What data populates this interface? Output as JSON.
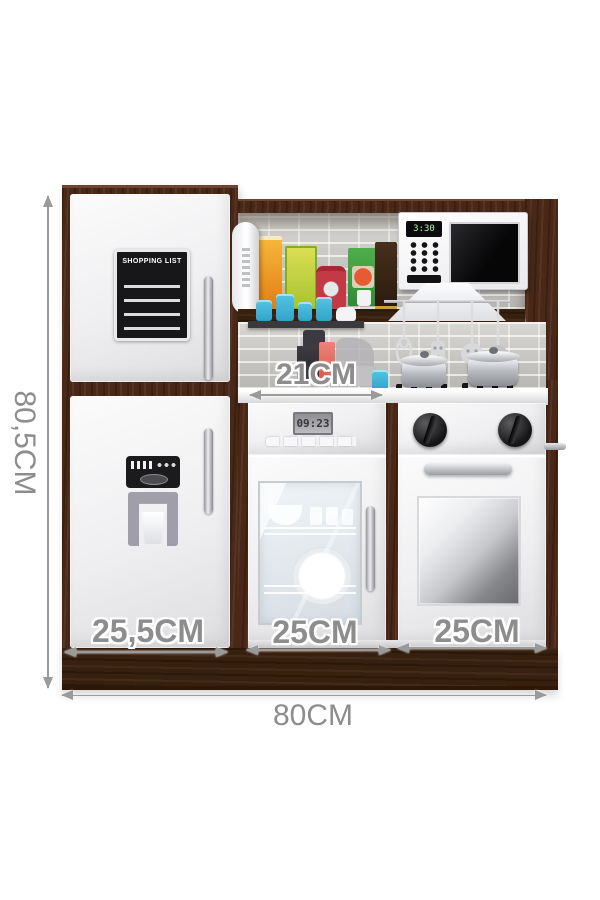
{
  "annotations": {
    "height": {
      "label": "80,5CM"
    },
    "countertop": {
      "label": "21CM"
    },
    "bottom_sections": [
      {
        "label": "25,5CM"
      },
      {
        "label": "25CM"
      },
      {
        "label": "25CM"
      }
    ],
    "total_width": {
      "label": "80CM"
    }
  },
  "kitchen": {
    "fridge": {
      "shopping_list_title": "SHOPPING LIST"
    },
    "microwave": {
      "display": "3:30"
    },
    "dishwasher": {
      "clock": "09:23"
    }
  },
  "colors": {
    "wood": "#4a2817",
    "wood_dark": "#38200f",
    "door_white": "#efeff1",
    "brick": "#c9c8c4",
    "label_text": "#8d8d8d",
    "accent_blue": "#41b3d6",
    "microwave_display_text": "#b4f2b0",
    "coffee_machine_red": "#e06a5f"
  }
}
